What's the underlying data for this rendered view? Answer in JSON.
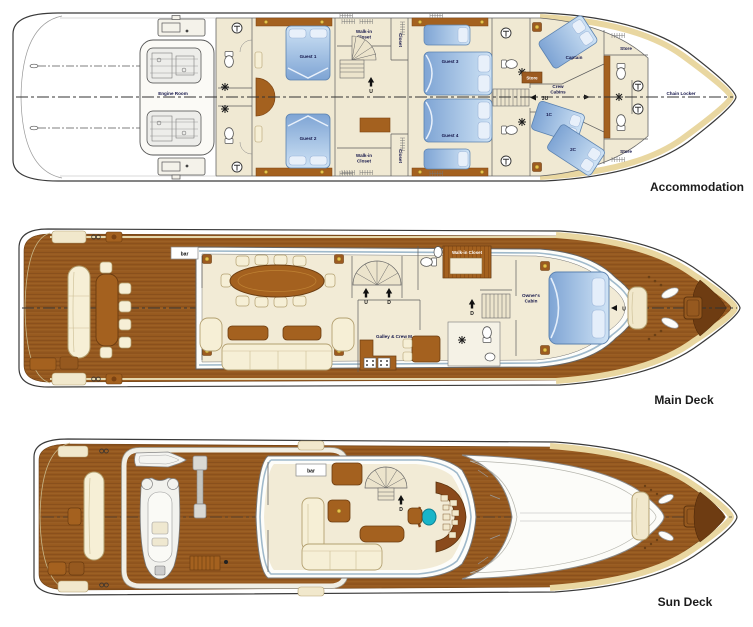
{
  "decks": {
    "accommodation": {
      "deck_label": "Accommodation",
      "rooms": {
        "engine_room": "Engine Room",
        "guest_1": "Guest 1",
        "guest_2": "Guest 2",
        "guest_3": "Guest 3",
        "guest_4": "Guest 4",
        "walk_in_closet_port": "Walk-in\nCloset",
        "walk_in_closet_stbd": "Walk-in\nCloset",
        "closet_port": "Closet",
        "closet_stbd": "Closet",
        "captain": "Captain",
        "crew_cabins": "Crew\nCabins",
        "crew_cabin_1c": "1C",
        "crew_cabin_2c": "2C",
        "store_amidships": "Store",
        "store_bow_port": "Store",
        "store_bow_stbd": "Store",
        "chain_locker": "Chain Locker"
      },
      "stairs": {
        "up": "U",
        "up_3": "3U"
      }
    },
    "main_deck": {
      "deck_label": "Main Deck",
      "rooms": {
        "bar": "bar",
        "walk_in_closet": "Walk-in Closet",
        "galley_crew_mess": "Galley & Crew M",
        "owners_cabin": "Owner's\nCabin"
      },
      "stairs": {
        "up": "U",
        "down": "D",
        "down_inner": "D",
        "bow_up": "U"
      }
    },
    "sun_deck": {
      "deck_label": "Sun Deck",
      "rooms": {
        "bar": "bar"
      },
      "stairs": {
        "down": "D"
      }
    }
  },
  "colors": {
    "teak": "#96591f",
    "teak_seam": "#7a4417",
    "wood_furniture": "#a4611f",
    "wood_dark": "#6b3c10",
    "cream_floor": "#f0e9d3",
    "cushion": "#f6efd6",
    "bed_blue": "#86abd8",
    "bed_blue_light": "#cfe3f5",
    "hull_band": "#e9d7a1",
    "window_line": "#9fb9cb",
    "helm_seat": "#19b5c8",
    "label_text": "#15164a"
  }
}
